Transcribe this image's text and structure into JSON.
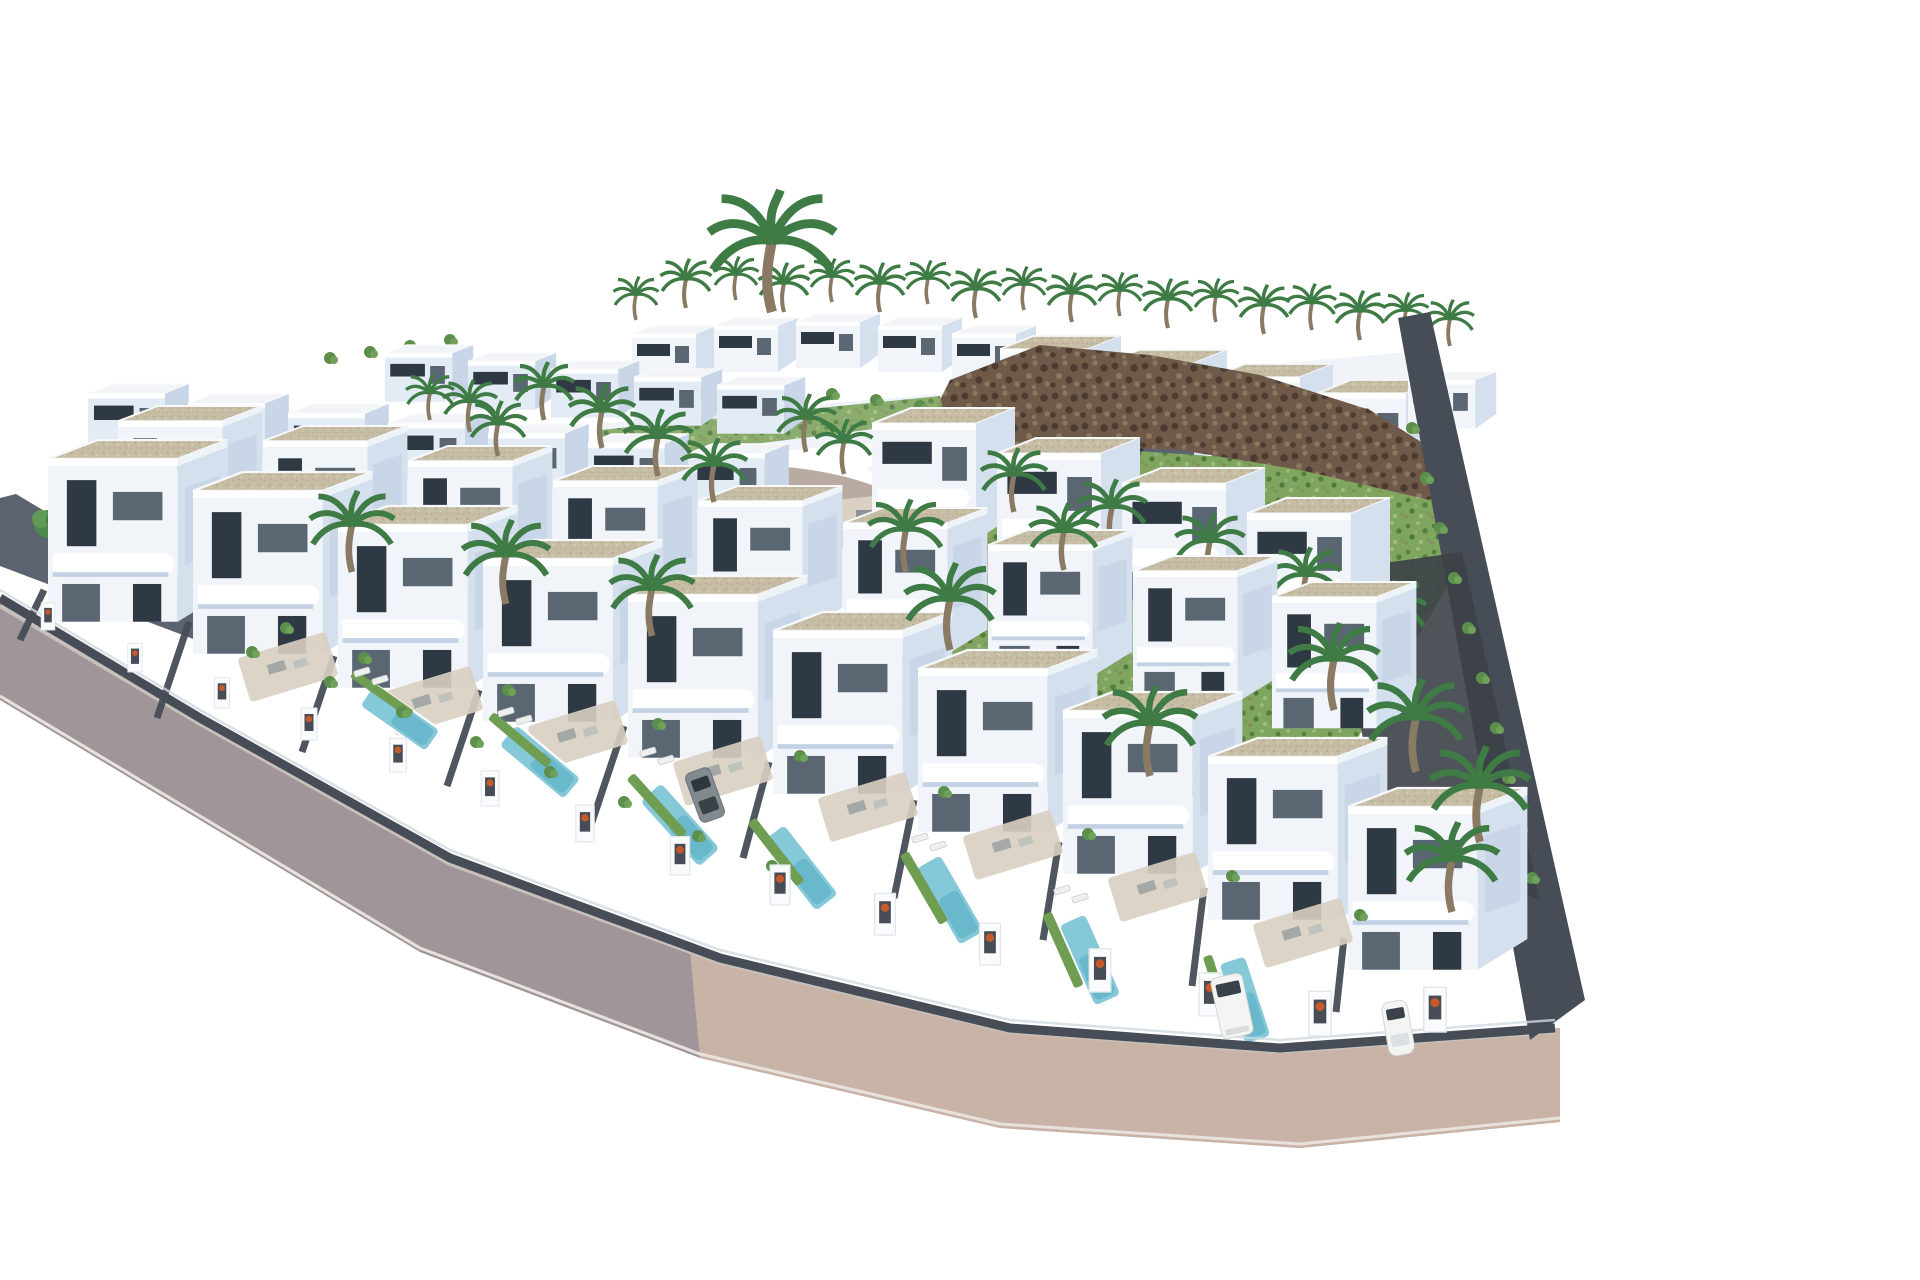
{
  "scene": {
    "description": "Aerial 3D architectural rendering of a hillside residential development: diagonal rows of modern white flat-roofed villas with gravel roof terraces and curved balconies, private turquoise lap pools behind dark grey yard walls with white gate pillars, palm trees along a back ridge of houses, a green scrubland hill with a brown rocky ridge on the upper right, a mauve asphalt road with a beige sidewalk wrapping the bottom edge, and a few white and grey cars parked along the street. No text or UI elements are visible."
  },
  "colors": {
    "background": "#ffffff",
    "villa_front": "#f1f5fa",
    "villa_side": "#d5e0ee",
    "villa_shade": "#c2d1e3",
    "window_dark": "#2e3943",
    "window_mid": "#5a6672",
    "roof_gravel": "#c6bda4",
    "roof_gravel_dot": "#b1a88e",
    "wall_dark": "#474d57",
    "wall_mid": "#5c6370",
    "road": "#a09599",
    "road_edge": "#c7c0bb",
    "sidewalk": "#c9b3a7",
    "curb": "#b5a69e",
    "pool_light": "#85c8d7",
    "pool_deep": "#4fa8bf",
    "lawn": "#6f9e53",
    "scrub": "#7fa55f",
    "scrub_dark": "#55813f",
    "scrub_light": "#a3bd7d",
    "rock": "#6f5948",
    "rock_dark": "#4c3b31",
    "rock_light": "#8d7660",
    "palm_green": "#3e7b45",
    "trunk": "#8a7a63",
    "terrace": "#d9cfc2",
    "tree_green": "#4e8a4a",
    "bush_green": "#5d8f4c",
    "car_white": "#f4f4f2",
    "car_grey": "#82898f",
    "plant_orange": "#c65a2a"
  }
}
